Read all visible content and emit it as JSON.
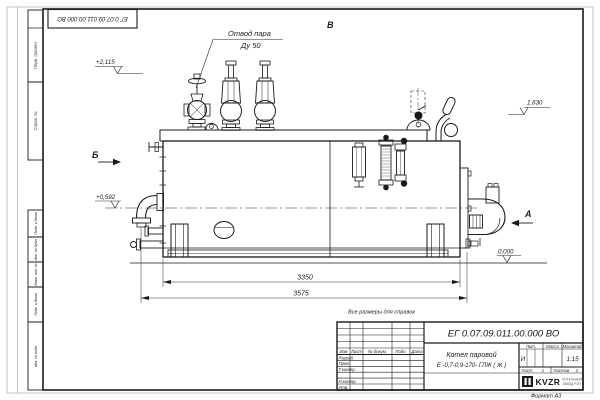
{
  "stamp": {
    "designation_rotated": "ЕГ 0.07.09.011.00.000  ВО"
  },
  "margin_columns": {
    "c1": "Перв. примен.",
    "c2": "Справ. №",
    "c3": "Подп. и дата",
    "c4": "Инв. № дубл.",
    "c5": "Взам. инв. №",
    "c6": "Подп. и дата",
    "c7": "Инв. № подл."
  },
  "callouts": {
    "steam_outlet": "Отвод пара",
    "steam_outlet_dn": "Ду 50"
  },
  "view_markers": {
    "a": "А",
    "b": "Б",
    "v": "В"
  },
  "elevations": {
    "e1": "+2,115",
    "e2": "1,630",
    "e3": "+0,592",
    "e4": "0,000"
  },
  "dimensions": {
    "d1": "3350",
    "d2": "3575"
  },
  "note": "Все размеры для справок",
  "title_block": {
    "designation": "ЕГ 0.07.09.011.00.000  ВО",
    "name_line1": "Котел паровой",
    "name_line2": "Е -0,7-0,9-170- ГЛЖ ( Ж )",
    "col_izm": "Изм",
    "col_list": "Лист",
    "col_doc": "№ докум.",
    "col_podp": "Подп.",
    "col_data": "Дата",
    "row_razrab": "Разраб.",
    "row_prov": "Пров.",
    "row_tkontr": "Т.контр.",
    "row_nkontr": "Н.контр.",
    "row_utv": "Утв.",
    "lit_header": "Лит.",
    "mass_header": "Масса",
    "scale_header": "Масштаб",
    "lit_value": "И",
    "scale_value": "1:15",
    "sheet_label": "Лист",
    "sheet_value": "1",
    "sheets_label": "Листов",
    "sheets_value": "2",
    "logo": "KVZR",
    "logo_line1": "КОТЕЛЬНЫЙ",
    "logo_line2": "ЗАВОД РЭП",
    "format": "Формат А3"
  }
}
